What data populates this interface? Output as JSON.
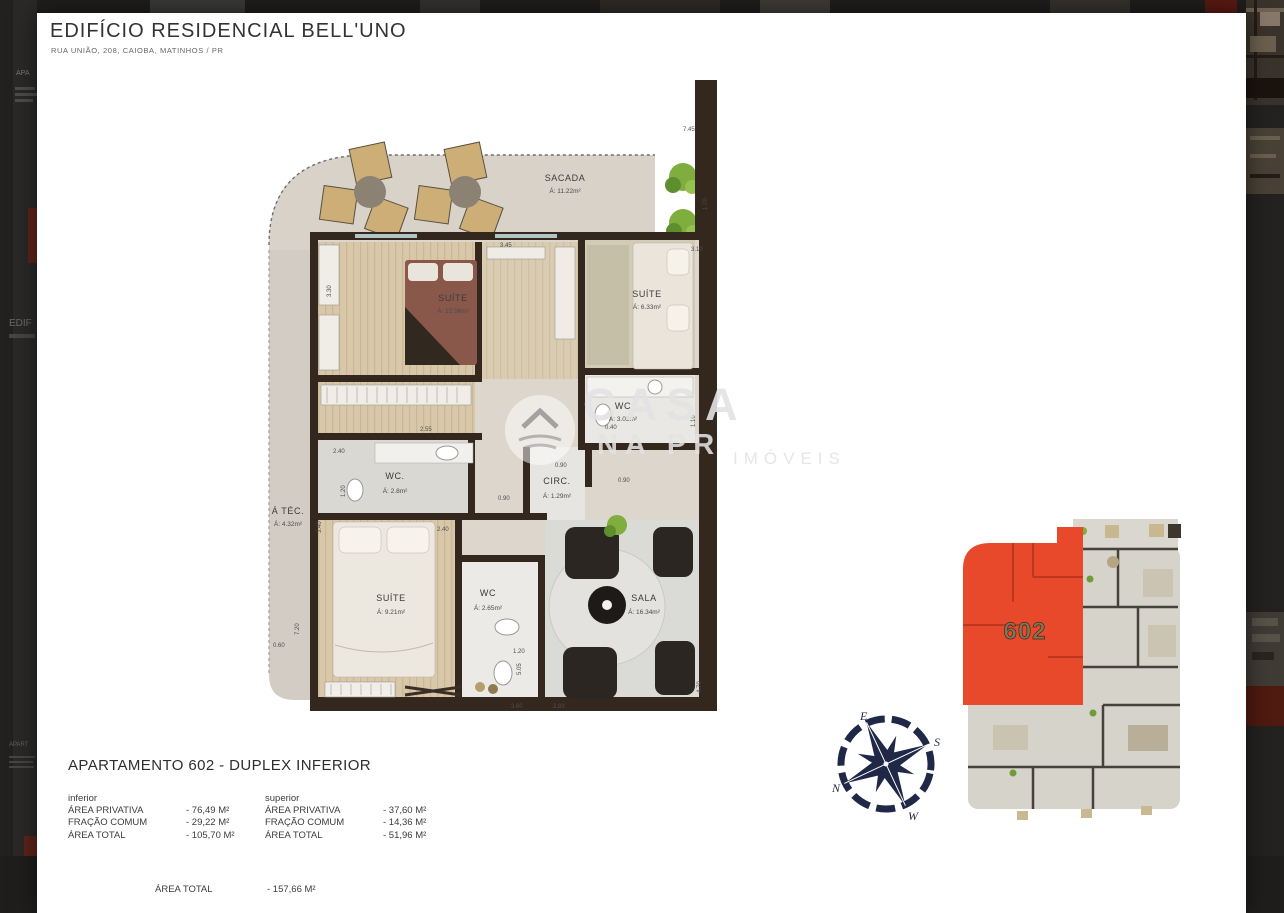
{
  "header": {
    "title": "EDIFÍCIO RESIDENCIAL BELL'UNO",
    "address": "RUA UNIÃO, 208, CAIOBA, MATINHOS / PR"
  },
  "floor_plan": {
    "rooms": [
      {
        "name": "SACADA",
        "area": "Á: 11.22m²"
      },
      {
        "name": "SUÍTE",
        "area": "Á: 12.56m²"
      },
      {
        "name": "SUÍTE",
        "area": "Á: 6.33m²"
      },
      {
        "name": "WC",
        "area": "Á: 3.03m²"
      },
      {
        "name": "WC.",
        "area": "Á: 2.8m²"
      },
      {
        "name": "CIRC.",
        "area": "Á: 1.29m²"
      },
      {
        "name": "Á TÉC.",
        "area": "Á: 4.32m²"
      },
      {
        "name": "SUÍTE",
        "area": "Á: 9.21m²"
      },
      {
        "name": "WC",
        "area": "Á: 2.65m²"
      },
      {
        "name": "SALA",
        "area": "Á: 16.34m²"
      }
    ],
    "dims": [
      "7.45",
      "1.70",
      "3.45",
      "3.10",
      "3.30",
      "2.55",
      "2.40",
      "1.20",
      "2.40",
      "3.40",
      "0.90",
      "0.90",
      "0.90",
      "0.40",
      "1.10",
      "0.60",
      "7.20",
      "5.05",
      "1.20",
      "3.60",
      "2.83",
      "4.70"
    ]
  },
  "watermark": {
    "line1": "CASA",
    "line2": "NA PR",
    "line3": "IMÓVEIS"
  },
  "key_plan": {
    "unit": "602"
  },
  "compass": {
    "n": "N",
    "e": "E",
    "s": "S",
    "w": "W"
  },
  "details": {
    "title": "APARTAMENTO 602 - DUPLEX INFERIOR",
    "columns": [
      {
        "heading": "inferior",
        "rows": [
          [
            "ÁREA PRIVATIVA",
            "- 76,49 M²"
          ],
          [
            "FRAÇÃO COMUM",
            "- 29,22 M²"
          ],
          [
            "ÁREA TOTAL",
            "- 105,70 M²"
          ]
        ]
      },
      {
        "heading": "superior",
        "rows": [
          [
            "ÁREA PRIVATIVA",
            "- 37,60 M²"
          ],
          [
            "FRAÇÃO COMUM",
            "- 14,36 M²"
          ],
          [
            "ÁREA TOTAL",
            "- 51,96 M²"
          ]
        ]
      }
    ],
    "total": {
      "label": "ÁREA TOTAL",
      "value": "- 157,66 M²"
    }
  },
  "edges": {
    "left": [
      "APA",
      "EDIF",
      "APART"
    ]
  }
}
